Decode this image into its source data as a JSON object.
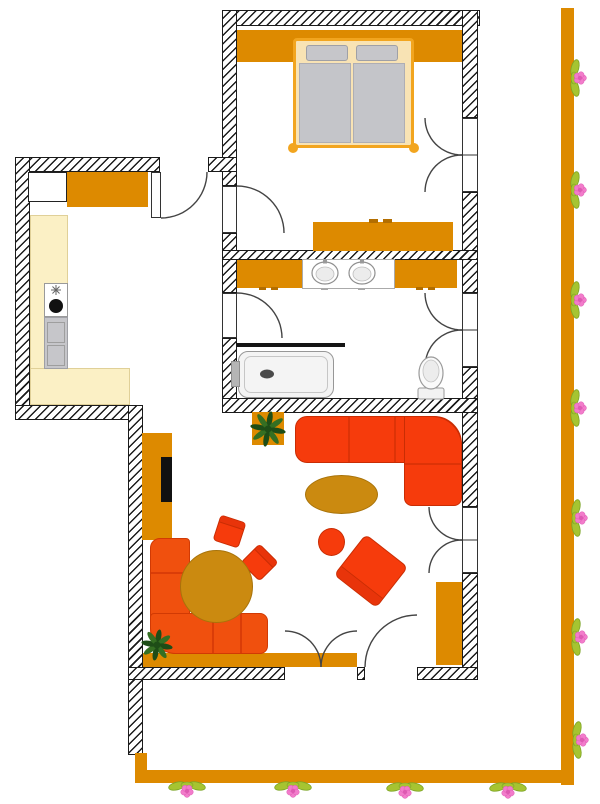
{
  "scene": {
    "type": "apartment-floor-plan",
    "rooms": [
      "bedroom",
      "hall-kitchen",
      "bathroom",
      "living-room",
      "terrace",
      "garden"
    ],
    "furniture": [
      "double-bed",
      "wardrobe",
      "dresser",
      "kitchen-counter",
      "stove",
      "dishwasher",
      "double-sink-vanity",
      "bathtub",
      "toilet",
      "corner-sofa",
      "oval-coffee-table",
      "stool",
      "armchair",
      "dining-table",
      "corner-bench",
      "chairs",
      "tv-cabinet",
      "sideboard",
      "potted-plants",
      "flower-border"
    ]
  },
  "palette": {
    "wallLine": "#1b1b1b",
    "orange": "#DD8A00",
    "orangeDark": "#B36E00",
    "mustard": "#CB8A10",
    "mustardDark": "#A8730A",
    "red": "#F63B0C",
    "redDark": "#C92D04",
    "benchRed": "#F0500E",
    "benchDark": "#D13A04",
    "cream": "#FBF0C5",
    "creamEdge": "#E0D098",
    "bedFrame": "#F2A51F",
    "bedInner": "#F8E3B4",
    "gray": "#C6C6CA",
    "grayDark": "#9FA0A6",
    "fixture": "#F4F4F4",
    "fixtureLine": "#979797",
    "plantDark": "#1E4D17",
    "plantLight": "#356F22",
    "leafGreen": "#A6C431",
    "leafDark": "#7BA426",
    "pink": "#F27CCB",
    "pinkDark": "#DE5AB2"
  },
  "doors": [
    {
      "id": "entrance",
      "hinge": [
        161,
        172
      ],
      "r": 46,
      "a0": 0,
      "a1": 90
    },
    {
      "id": "bedroom",
      "hinge": [
        237,
        233
      ],
      "r": 47,
      "a0": 270,
      "a1": 360
    },
    {
      "id": "bathroom-left",
      "hinge": [
        237,
        338
      ],
      "r": 45,
      "a0": 270,
      "a1": 360
    },
    {
      "id": "bathroom-right-1",
      "hinge": [
        462,
        293
      ],
      "r": 37,
      "a0": 180,
      "a1": 90
    },
    {
      "id": "bathroom-right-2",
      "hinge": [
        462,
        367
      ],
      "r": 37,
      "a0": 180,
      "a1": 270
    },
    {
      "id": "bedroom-right-1",
      "hinge": [
        462,
        118
      ],
      "r": 37,
      "a0": 180,
      "a1": 90
    },
    {
      "id": "bedroom-right-2",
      "hinge": [
        462,
        192
      ],
      "r": 37,
      "a0": 180,
      "a1": 270
    },
    {
      "id": "terrace-left-1",
      "hinge": [
        285,
        667
      ],
      "r": 36,
      "a0": 270,
      "a1": 360
    },
    {
      "id": "terrace-left-2",
      "hinge": [
        357,
        667
      ],
      "r": 36,
      "a0": 270,
      "a1": 180
    },
    {
      "id": "terrace-single",
      "hinge": [
        417,
        667
      ],
      "r": 52,
      "a0": 180,
      "a1": 270
    },
    {
      "id": "living-right-1",
      "hinge": [
        462,
        507
      ],
      "r": 33,
      "a0": 180,
      "a1": 90
    },
    {
      "id": "living-right-2",
      "hinge": [
        462,
        573
      ],
      "r": 33,
      "a0": 180,
      "a1": 270
    }
  ],
  "jamb_lines": [
    [
      462,
      155,
      478,
      155
    ],
    [
      462,
      330,
      478,
      330
    ],
    [
      462,
      540,
      478,
      540
    ]
  ],
  "plants": [
    {
      "x": 268,
      "y": 429,
      "r": 17
    },
    {
      "x": 157,
      "y": 645,
      "r": 15
    }
  ],
  "flowers": {
    "fence": [
      [
        576,
        78
      ],
      [
        576,
        190
      ],
      [
        576,
        300
      ],
      [
        576,
        408
      ],
      [
        577,
        518
      ],
      [
        577,
        637
      ],
      [
        578,
        740
      ]
    ],
    "bottom": [
      [
        187,
        787
      ],
      [
        293,
        787
      ],
      [
        405,
        788
      ],
      [
        508,
        788
      ]
    ]
  },
  "bathroom": {
    "sinks": [
      {
        "cx": 325,
        "cy": 273
      },
      {
        "cx": 362,
        "cy": 273
      }
    ],
    "toilet": {
      "cx": 431,
      "cy": 373
    },
    "tub_drain": {
      "cx": 267,
      "cy": 374
    }
  },
  "kitchen": {
    "burner": {
      "cx": 56,
      "cy": 306,
      "r": 7
    },
    "star": {
      "cx": 56,
      "cy": 290
    }
  }
}
